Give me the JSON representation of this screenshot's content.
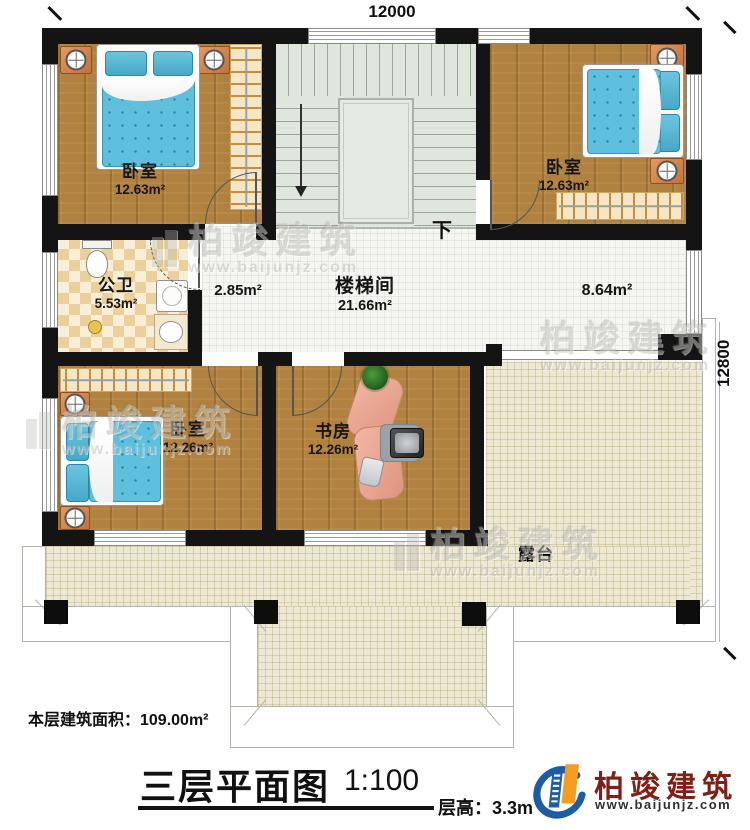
{
  "dimensions": {
    "top": "12000",
    "right": "12800"
  },
  "rooms": {
    "bedroom_tl": {
      "name": "卧室",
      "area": "12.63m²"
    },
    "bedroom_tr": {
      "name": "卧室",
      "area": "12.63m²"
    },
    "bedroom_bl": {
      "name": "卧室",
      "area": "12.26m²"
    },
    "study": {
      "name": "书房",
      "area": "12.26m²"
    },
    "bathroom": {
      "name": "公卫",
      "area": "5.53m²"
    },
    "stairwell": {
      "name": "楼梯间",
      "area": "21.66m²"
    },
    "hall_small": {
      "area": "2.85m²"
    },
    "corridor": {
      "area": "8.64m²"
    },
    "terrace": {
      "name": "露台"
    }
  },
  "stairs": {
    "down_label": "下"
  },
  "footer": {
    "floor_area": "本层建筑面积：109.00m²",
    "title": "三层平面图",
    "scale": "1:100",
    "floor_height": "层高：3.3m"
  },
  "logo": {
    "brand": "柏竣建筑",
    "url": "www.baijunjz.com"
  },
  "watermark": {
    "brand": "柏竣建筑",
    "url": "www.baijunjz.com"
  },
  "colors": {
    "wall": "#141414",
    "wood_floor": "#b0813f",
    "tile_white": "#f5f5f2",
    "tile_terrace": "#ece8d2",
    "tile_bath_a": "#ecd09b",
    "tile_bath_b": "#f9efd9",
    "stair_floor": "#e0e5dd",
    "mattress_blue": "#5fc0dd",
    "nightstand_orange": "#d98e57",
    "wardrobe_cream": "#f6e7c4",
    "desk_salmon": "#eeab97",
    "logo_red": "#7e2016",
    "logo_blue": "#1d5ca6",
    "logo_orange": "#f39c1f"
  }
}
